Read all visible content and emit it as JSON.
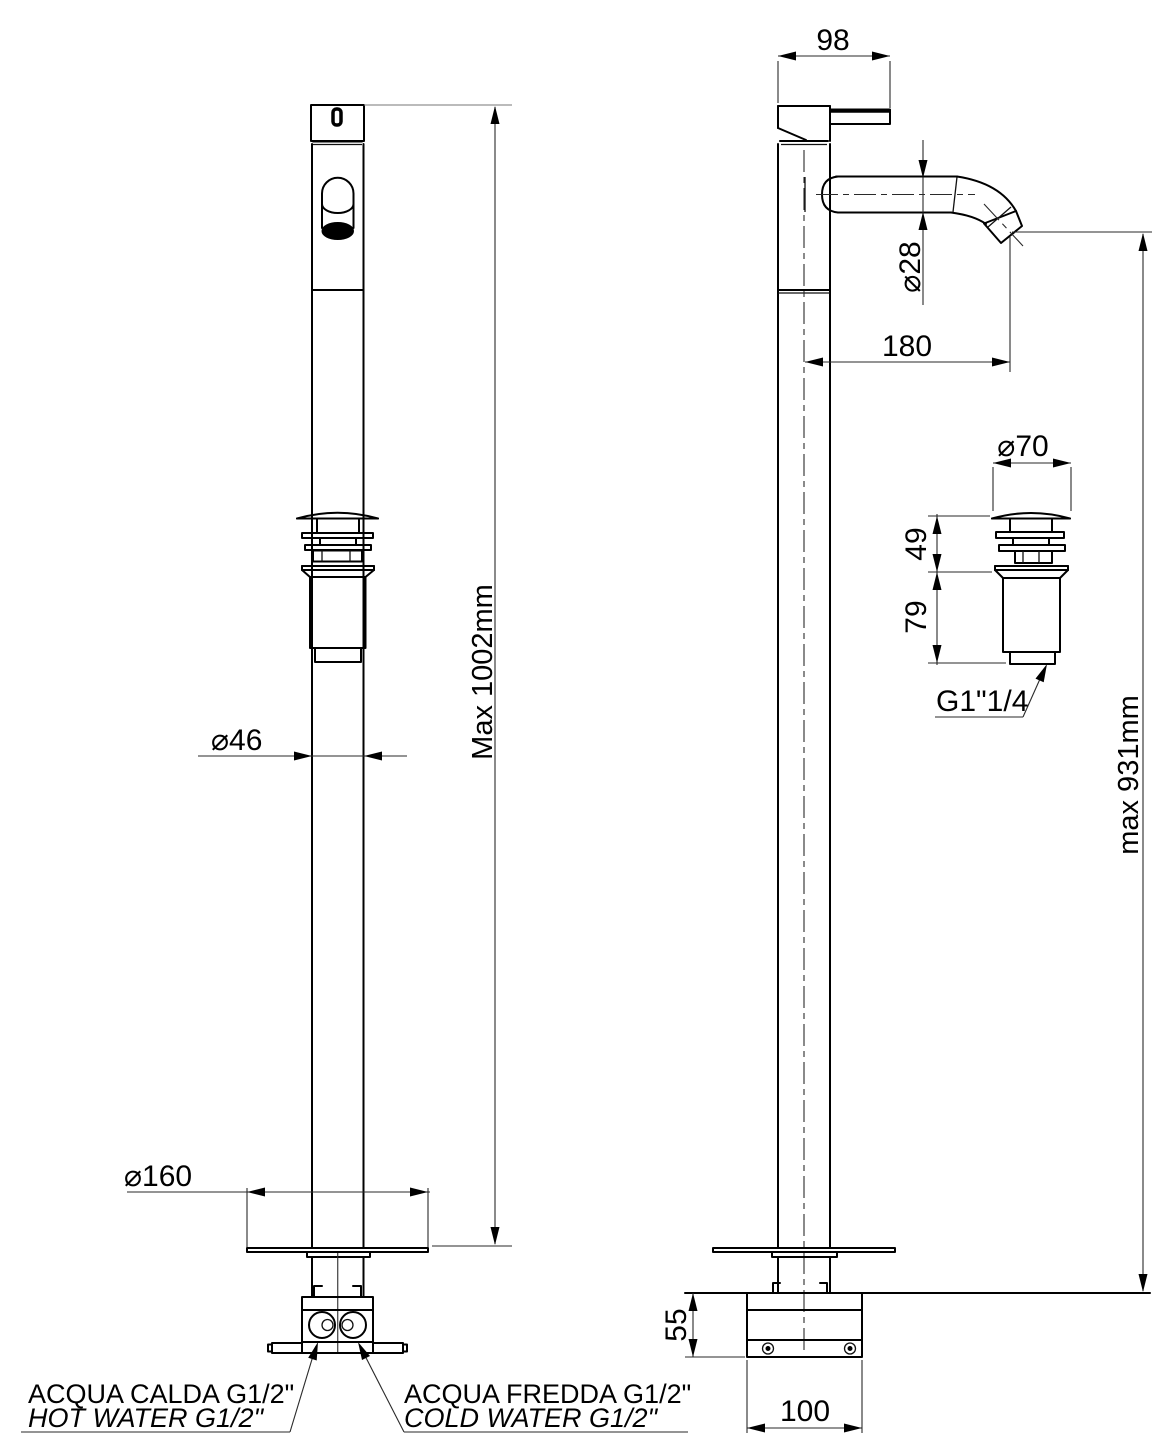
{
  "drawing": {
    "title": "Floor-standing basin mixer – dimensioned technical drawing (front and side views)",
    "colors": {
      "line": "#000000",
      "hot": "#ff0000",
      "cold": "#0000ff"
    },
    "dimensions": {
      "overall_height": "Max 1002mm",
      "column_diameter": "⌀46",
      "base_plate_diameter": "⌀160",
      "handle_length": "98",
      "spout_diameter": "⌀28",
      "spout_reach": "180",
      "drain_cap_diameter": "⌀70",
      "drain_top_height": "49",
      "drain_body_height": "79",
      "drain_thread": "G1\"1/4",
      "spout_height": "max 931mm",
      "base_height": "55",
      "base_width": "100"
    },
    "connections": {
      "hot_line1": "ACQUA CALDA G1/2\"",
      "hot_line2": "HOT WATER G1/2\"",
      "cold_line1": "ACQUA FREDDA G1/2\"",
      "cold_line2": "COLD WATER G1/2\""
    }
  }
}
